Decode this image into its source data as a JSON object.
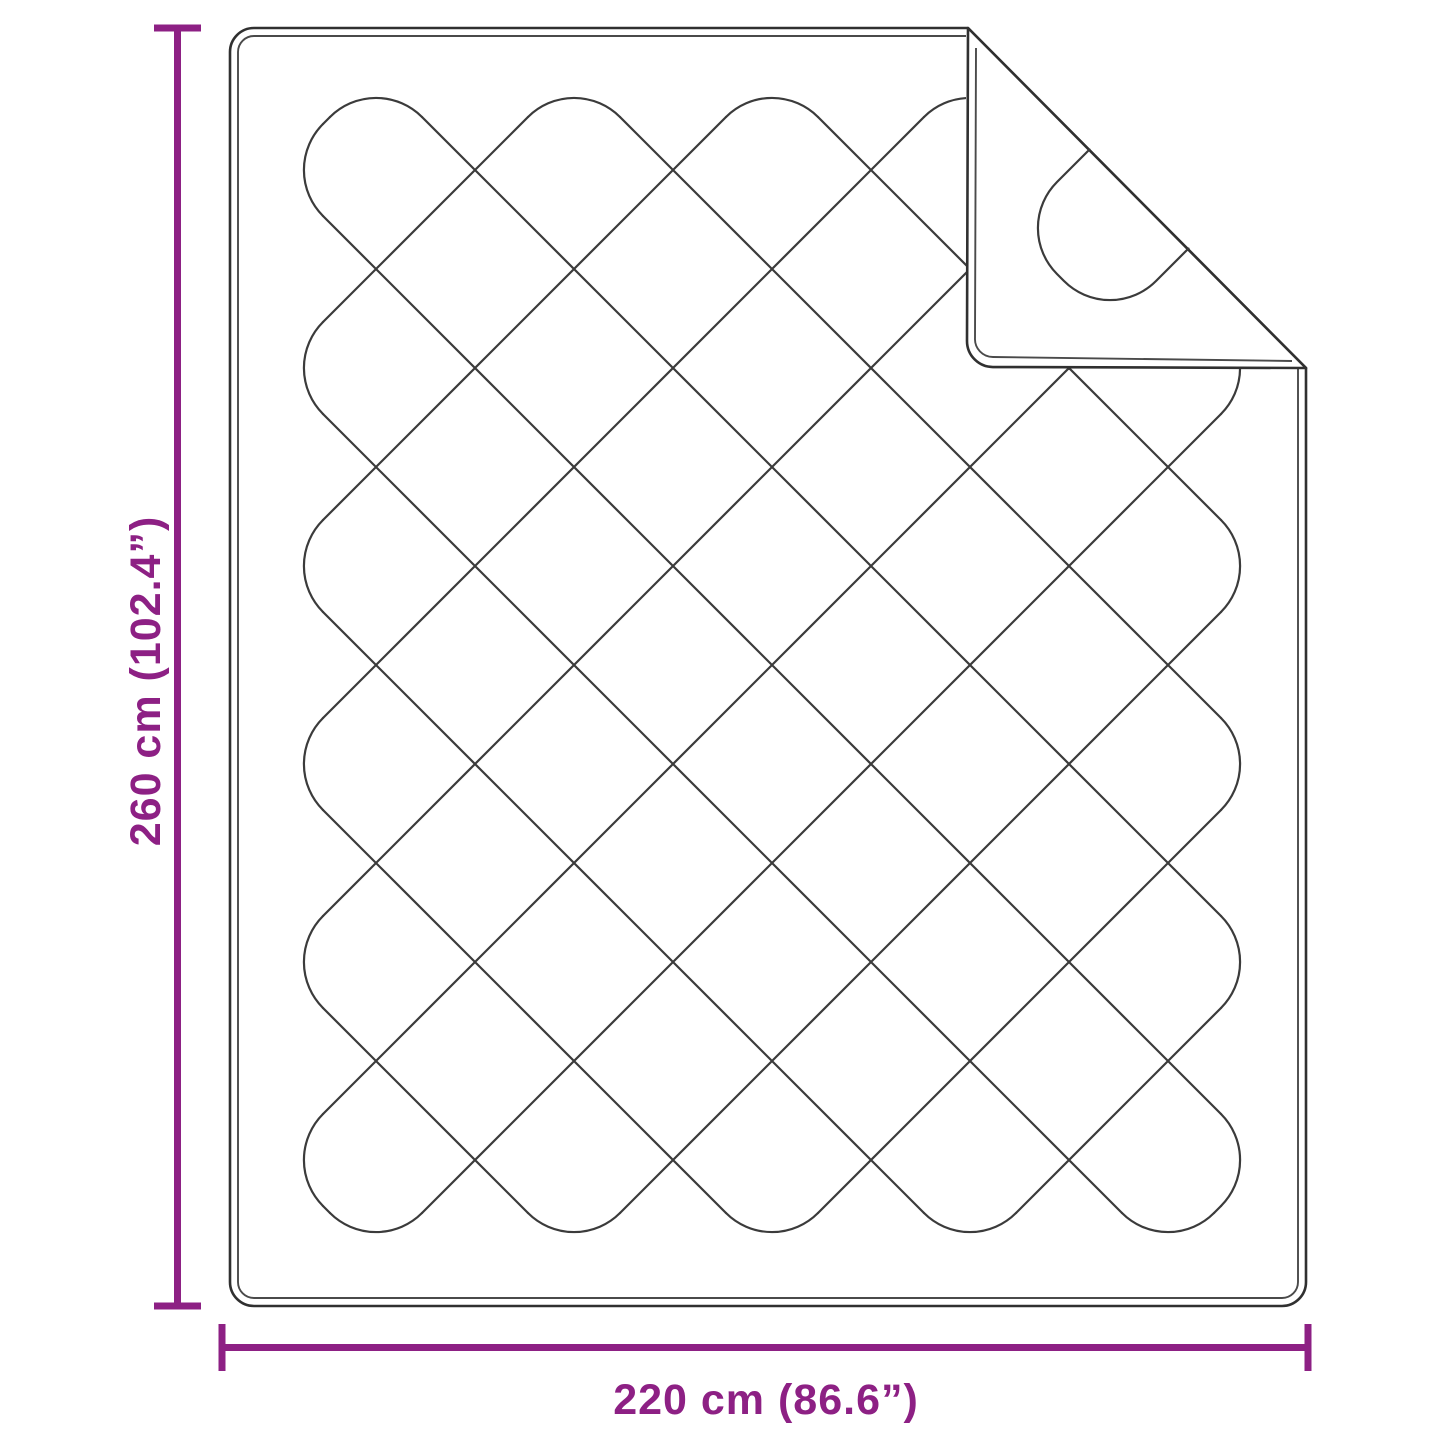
{
  "diagram": {
    "subject": "quilted-blanket-with-folded-corner",
    "vertical_dimension": {
      "label": "260 cm (102.4”)"
    },
    "horizontal_dimension": {
      "label": "220 cm (86.6”)"
    }
  },
  "colors": {
    "dimension": "#8D2084",
    "outline": "#303030",
    "hem": "#4A4A4A",
    "pattern": "#3B3B3B",
    "background": "#FFFFFF"
  }
}
